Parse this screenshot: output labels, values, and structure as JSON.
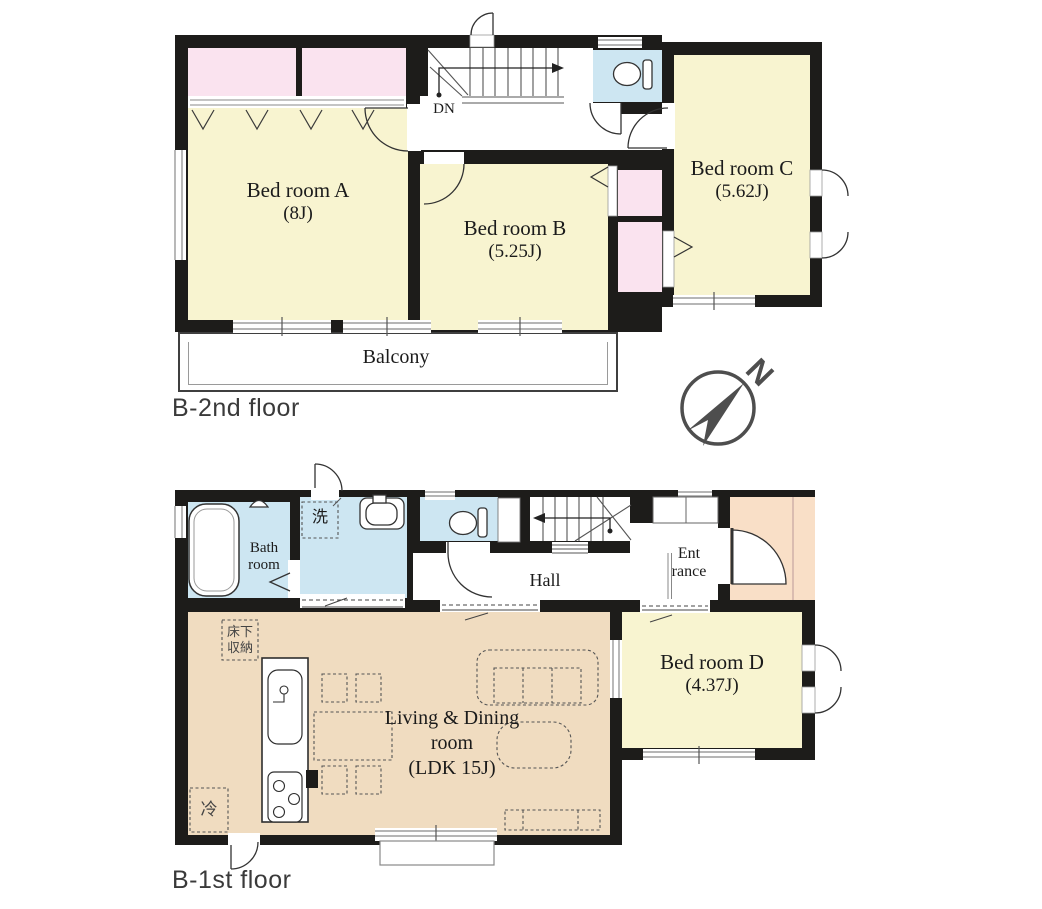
{
  "colors": {
    "wall": "#1d1c1a",
    "room_yellow": "#f8f4d0",
    "closet_pink": "#fae3ef",
    "water_blue": "#cde6f2",
    "ldk_tan": "#f0dcc0",
    "porch_peach": "#f9dfc7",
    "compass_gray": "#4e4e4e",
    "label_gray": "#3a3a3a"
  },
  "compass": {
    "north": "N"
  },
  "floor2": {
    "label": "B-2nd floor",
    "dn": "DN",
    "bedroom_a_name": "Bed room A",
    "bedroom_a_size": "(8J)",
    "bedroom_b_name": "Bed room B",
    "bedroom_b_size": "(5.25J)",
    "bedroom_c_name": "Bed room C",
    "bedroom_c_size": "(5.62J)",
    "balcony": "Balcony"
  },
  "floor1": {
    "label": "B-1st floor",
    "bath_line1": "Bath",
    "bath_line2": "room",
    "laundry": "洗",
    "hall": "Hall",
    "entrance_line1": "Ent",
    "entrance_line2": "rance",
    "ldk_line1": "Living & Dining",
    "ldk_line2": "room",
    "ldk_line3": "(LDK 15J)",
    "bedroom_d_name": "Bed room D",
    "bedroom_d_size": "(4.37J)",
    "underfloor_line1": "床下",
    "underfloor_line2": "収納",
    "fridge": "冷"
  }
}
